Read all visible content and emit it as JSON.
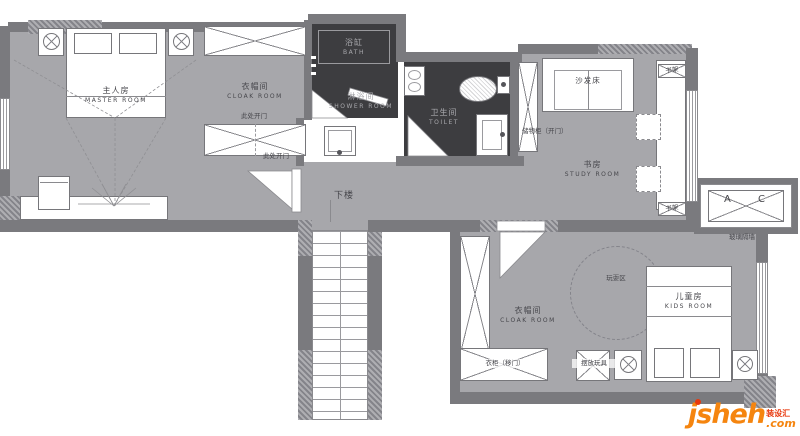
{
  "rooms": {
    "master": {
      "zh": "主人房",
      "en": "MASTER ROOM"
    },
    "cloak": {
      "zh": "衣帽间",
      "en": "CLOAK ROOM"
    },
    "bath": {
      "zh": "浴缸",
      "en": "BATH"
    },
    "shower": {
      "zh": "淋浴间",
      "en": "SHOWER ROOM"
    },
    "toilet": {
      "zh": "卫生间",
      "en": "TOILET"
    },
    "study": {
      "zh": "书房",
      "en": "STUDY ROOM"
    },
    "kids": {
      "zh": "儿童房",
      "en": "KIDS ROOM"
    },
    "kids_cloak": {
      "zh": "衣帽间",
      "en": "CLOAK ROOM"
    }
  },
  "annotations": {
    "open_here_a": "此处开门",
    "open_here_b": "此处开门",
    "downstairs": "下楼",
    "sofa_bed": "沙发床",
    "storage_cabinet": "储物柜（开门）",
    "bookshelf_top": "书架",
    "bookshelf_bottom": "书架",
    "ac_left": "A",
    "ac_right": "C",
    "glass_partition": "玻璃隔墙",
    "play_area": "玩耍区",
    "sliding_wardrobe": "衣柜（移门）",
    "toys": "摆放玩具"
  },
  "watermark": {
    "brand": "jsheh",
    "tld": ".com",
    "tag": "装设汇"
  },
  "colors": {
    "floor": "#a7a7ab",
    "wall": "#7a7a7e",
    "dark_floor": "#3d3d40",
    "hatch": "#9a9a9e",
    "accent_orange": "#f5850f",
    "accent_red": "#e8380d"
  }
}
